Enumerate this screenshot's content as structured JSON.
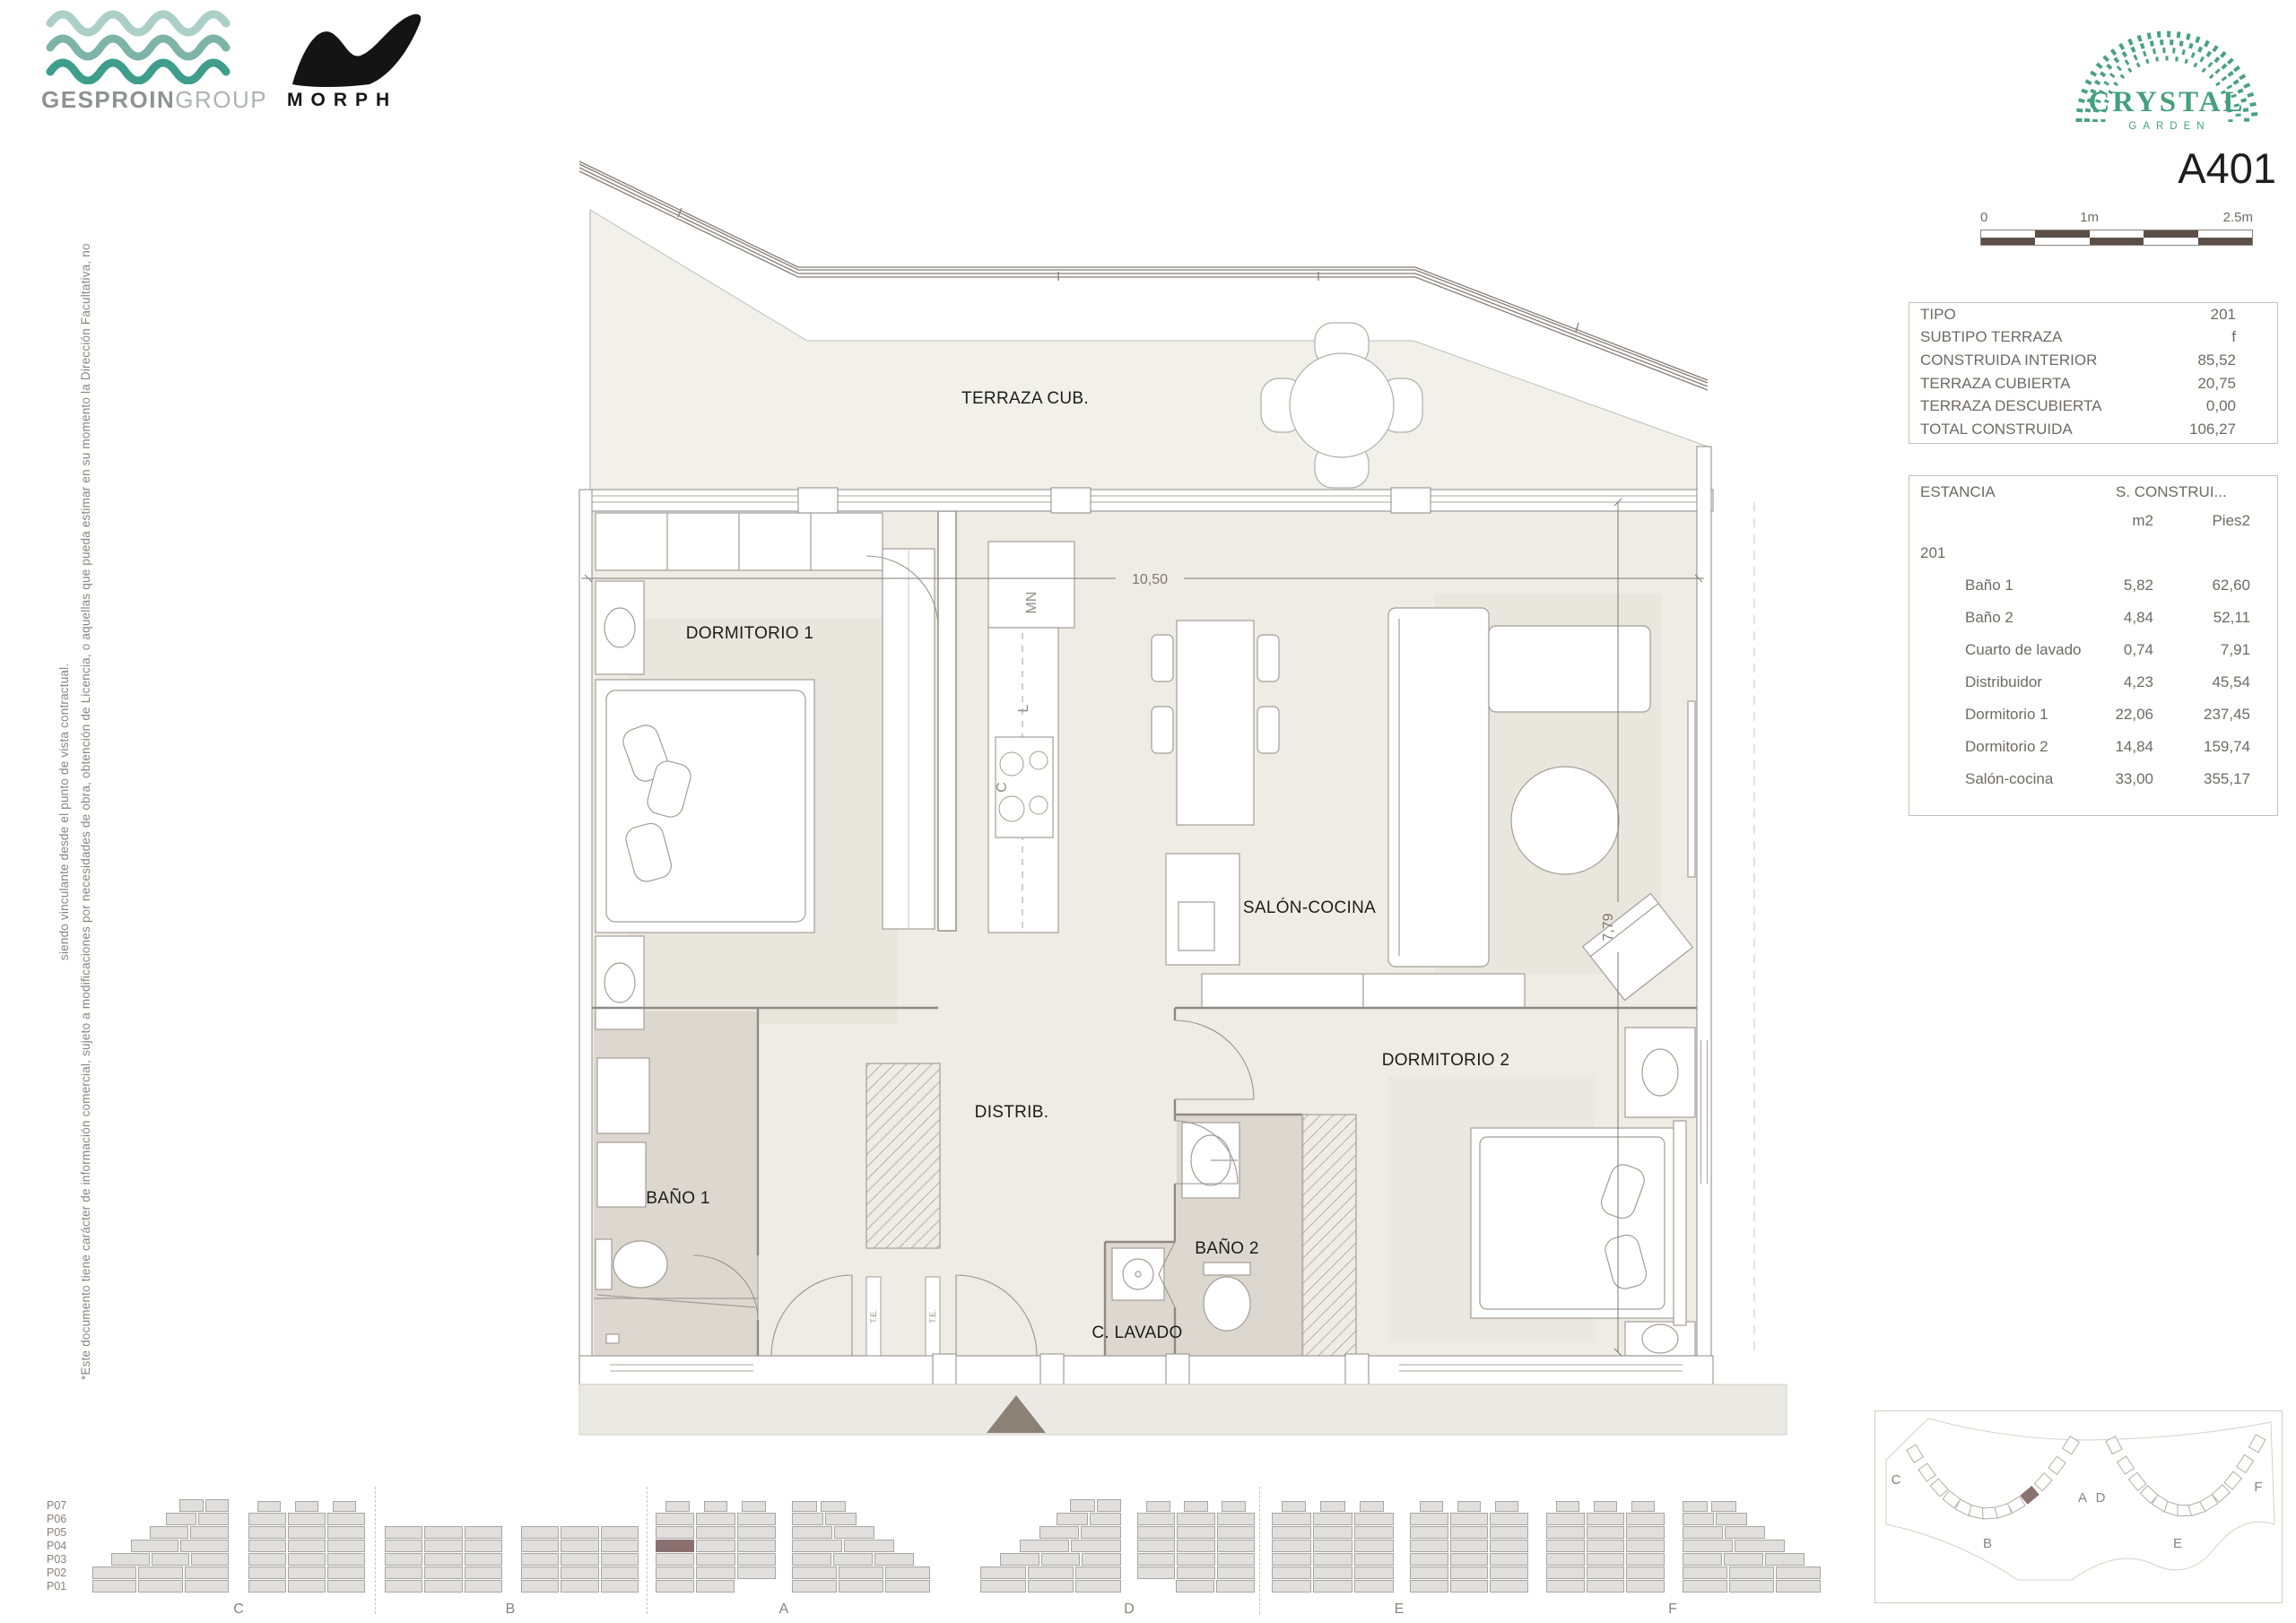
{
  "branding": {
    "gesproin": {
      "bold": "GESPROIN",
      "light": "GROUP"
    },
    "morph": "MORPH",
    "crystal": {
      "title": "CRYSTAL",
      "subtitle": "GARDEN"
    }
  },
  "unit_code": "A401",
  "scale_bar": {
    "labels": [
      "0",
      "1m",
      "2.5m"
    ]
  },
  "summary_table": {
    "rows": [
      [
        "TIPO",
        "201"
      ],
      [
        "SUBTIPO TERRAZA",
        "f"
      ],
      [
        "CONSTRUIDA INTERIOR",
        "85,52"
      ],
      [
        "TERRAZA CUBIERTA",
        "20,75"
      ],
      [
        "TERRAZA DESCUBIERTA",
        "0,00"
      ],
      [
        "TOTAL CONSTRUIDA",
        "106,27"
      ]
    ]
  },
  "rooms_table": {
    "header": "ESTANCIA",
    "header2": "S. CONSTRUI...",
    "col_m2": "m2",
    "col_pies": "Pies2",
    "group": "201",
    "rows": [
      [
        "Baño 1",
        "5,82",
        "62,60"
      ],
      [
        "Baño 2",
        "4,84",
        "52,11"
      ],
      [
        "Cuarto de lavado",
        "0,74",
        "7,91"
      ],
      [
        "Distribuidor",
        "4,23",
        "45,54"
      ],
      [
        "Dormitorio 1",
        "22,06",
        "237,45"
      ],
      [
        "Dormitorio 2",
        "14,84",
        "159,74"
      ],
      [
        "Salón-cocina",
        "33,00",
        "355,17"
      ]
    ]
  },
  "plan": {
    "labels": {
      "terraza": "TERRAZA CUB.",
      "dorm1": "DORMITORIO 1",
      "salon": "SALÓN-COCINA",
      "distrib": "DISTRIB.",
      "bano1": "BAÑO 1",
      "bano2": "BAÑO 2",
      "lavado": "C. LAVADO",
      "dorm2": "DORMITORIO 2",
      "kitchen_mn": "MN",
      "kitchen_l": "L",
      "kitchen_c": "C",
      "te": "T.E."
    },
    "dims": {
      "width": "10,50",
      "height": "7,79"
    }
  },
  "disclaimer": {
    "line1": "*Este documento tiene carácter de información comercial, sujeto a modificaciones por necesidades de obra, obtención de Licencia, o aquellas que pueda estimar en su momento la Dirección Facultativa, no",
    "line2": "siendo vinculante desde el punto de vista contractual."
  },
  "elevations": {
    "floors": [
      "P07",
      "P06",
      "P05",
      "P04",
      "P03",
      "P02",
      "P01"
    ],
    "blocks": [
      "C",
      "B",
      "A",
      "D",
      "E",
      "F"
    ],
    "highlight": {
      "block": "A",
      "floor": "P04"
    }
  },
  "siteplan": {
    "labels": [
      "C",
      "B",
      "A",
      "D",
      "E",
      "F"
    ]
  },
  "colors": {
    "accent_green": "#45a07c",
    "wave_light": "#accfc7",
    "wave_mid": "#7eb4a8",
    "wave_dark": "#3e9d8b",
    "highlight_unit": "#8a7170",
    "scalebar_dark": "#5c4f47",
    "floor_interior": "#efece6",
    "floor_terrace": "#f2f0ea",
    "floor_bath": "#dcd8d0"
  }
}
